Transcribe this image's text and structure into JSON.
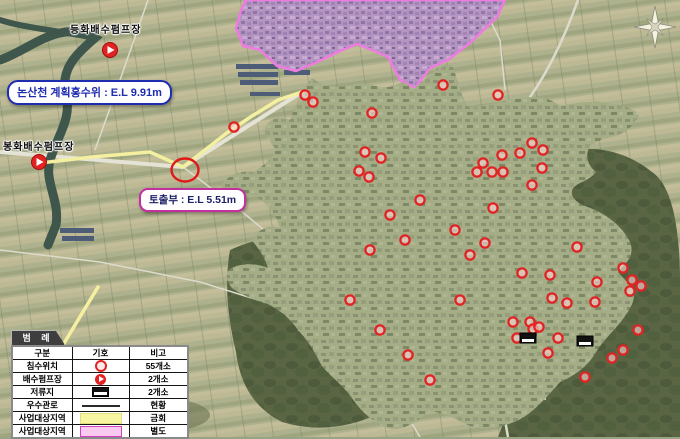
{
  "map": {
    "labels": {
      "pump_top": "등화배수펌프장",
      "pump_left": "봉화배수펌프장"
    },
    "callouts": {
      "flood_level": "논산천 계획홍수위 : E.L 9.91m",
      "outlet": "토출부 : E.L 5.51m"
    },
    "colors": {
      "project_area_current": "#f4f0a0",
      "project_area_separate_fill": "#b493c6",
      "project_area_separate_stroke": "#ee7ce0",
      "flood_marker": "#e02424",
      "pump_marker": "#e32222",
      "pipe": "#1a1a1a"
    },
    "flood_markers": [
      [
        305,
        95
      ],
      [
        313,
        102
      ],
      [
        372,
        113
      ],
      [
        365,
        152
      ],
      [
        381,
        158
      ],
      [
        359,
        171
      ],
      [
        369,
        177
      ],
      [
        234,
        127
      ],
      [
        443,
        85
      ],
      [
        498,
        95
      ],
      [
        483,
        163
      ],
      [
        492,
        172
      ],
      [
        502,
        155
      ],
      [
        503,
        172
      ],
      [
        520,
        153
      ],
      [
        532,
        143
      ],
      [
        543,
        150
      ],
      [
        542,
        168
      ],
      [
        532,
        185
      ],
      [
        493,
        208
      ],
      [
        477,
        172
      ],
      [
        485,
        243
      ],
      [
        577,
        247
      ],
      [
        522,
        273
      ],
      [
        550,
        275
      ],
      [
        597,
        282
      ],
      [
        623,
        268
      ],
      [
        632,
        280
      ],
      [
        641,
        286
      ],
      [
        630,
        291
      ],
      [
        595,
        302
      ],
      [
        567,
        303
      ],
      [
        552,
        298
      ],
      [
        513,
        322
      ],
      [
        530,
        322
      ],
      [
        533,
        329
      ],
      [
        539,
        327
      ],
      [
        517,
        338
      ],
      [
        558,
        338
      ],
      [
        548,
        353
      ],
      [
        638,
        330
      ],
      [
        623,
        350
      ],
      [
        612,
        358
      ],
      [
        585,
        377
      ],
      [
        390,
        215
      ],
      [
        405,
        240
      ],
      [
        370,
        250
      ],
      [
        420,
        200
      ],
      [
        455,
        230
      ],
      [
        470,
        255
      ],
      [
        350,
        300
      ],
      [
        380,
        330
      ],
      [
        408,
        355
      ],
      [
        430,
        380
      ],
      [
        460,
        300
      ]
    ],
    "pump_markers": [
      [
        110,
        50
      ],
      [
        39,
        162
      ]
    ],
    "reservoir_markers": [
      [
        528,
        338
      ],
      [
        585,
        341
      ]
    ],
    "flow_arrows": [
      [
        325,
        115,
        40
      ],
      [
        350,
        128,
        130
      ],
      [
        395,
        122,
        60
      ],
      [
        330,
        140,
        90
      ],
      [
        340,
        160,
        120
      ],
      [
        412,
        142,
        30
      ],
      [
        436,
        127,
        80
      ],
      [
        468,
        152,
        140
      ],
      [
        455,
        172,
        50
      ],
      [
        343,
        178,
        100
      ],
      [
        390,
        188,
        20
      ],
      [
        420,
        178,
        70
      ],
      [
        302,
        192,
        150
      ],
      [
        515,
        158,
        60
      ],
      [
        528,
        172,
        110
      ],
      [
        508,
        192,
        45
      ],
      [
        492,
        216,
        130
      ],
      [
        545,
        247,
        70
      ],
      [
        522,
        252,
        20
      ],
      [
        556,
        262,
        100
      ],
      [
        497,
        287,
        60
      ],
      [
        527,
        307,
        140
      ],
      [
        562,
        332,
        40
      ],
      [
        482,
        332,
        90
      ],
      [
        556,
        357,
        120
      ],
      [
        512,
        362,
        30
      ],
      [
        432,
        302,
        80
      ],
      [
        417,
        332,
        60
      ],
      [
        402,
        357,
        110
      ],
      [
        310,
        255,
        75
      ],
      [
        290,
        280,
        25
      ],
      [
        335,
        310,
        135
      ],
      [
        360,
        340,
        55
      ],
      [
        390,
        390,
        95
      ],
      [
        440,
        400,
        65
      ]
    ]
  },
  "legend": {
    "title": "범 례",
    "headers": [
      "구분",
      "기호",
      "비고"
    ],
    "rows": [
      {
        "label": "침수위치",
        "symbol": "flood-marker",
        "note": "55개소"
      },
      {
        "label": "배수펌프장",
        "symbol": "pump-marker",
        "note": "2개소"
      },
      {
        "label": "저류지",
        "symbol": "reservoir-marker",
        "note": "2개소"
      },
      {
        "label": "우수관로",
        "symbol": "pipe-line",
        "note": "현황"
      },
      {
        "label": "사업대상지역",
        "symbol": "area-current",
        "note": "금회"
      },
      {
        "label": "사업대상지역",
        "symbol": "area-separate",
        "note": "별도"
      }
    ]
  }
}
